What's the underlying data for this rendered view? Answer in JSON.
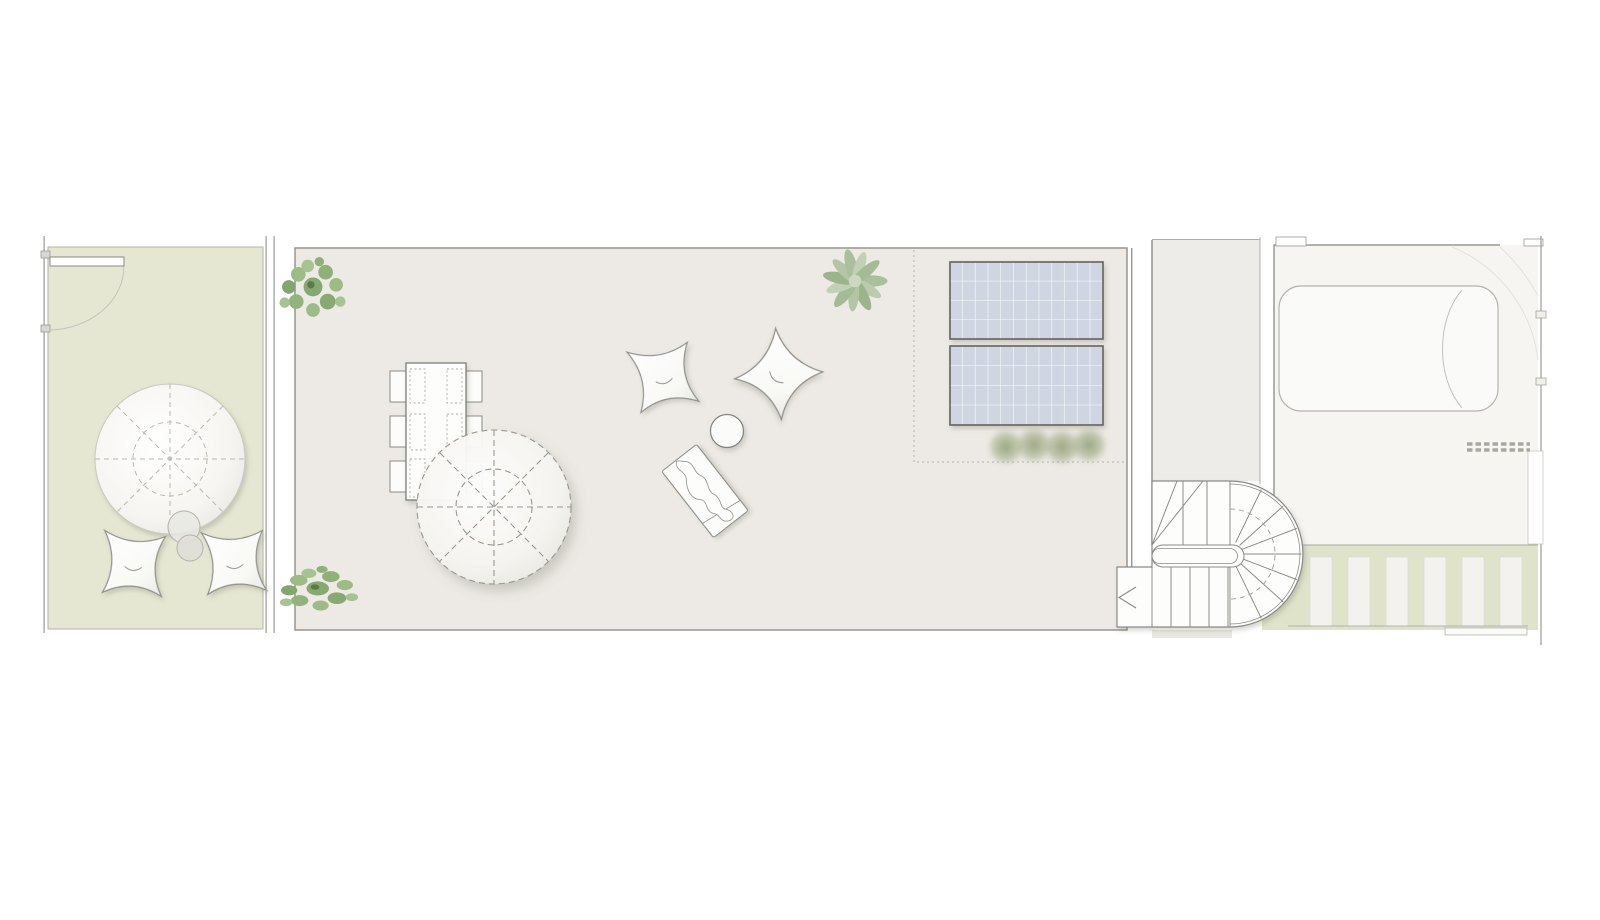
{
  "document": {
    "kind": "architectural-floor-plan",
    "view": "roof-terrace-plan",
    "visible_text": [],
    "orientation": "landscape"
  },
  "palette": {
    "page_bg": "#ffffff",
    "garden_fill": "#e5e7d3",
    "garden_border": "#b3b3aa",
    "terrace_fill": "#edeae5",
    "terrace_border": "#96968e",
    "corridor_fill": "#edece8",
    "building_fill": "#f6f5f1",
    "green_strip": "#dfe3ca",
    "paver": "#f3f2ee",
    "wall": "#9a9a94",
    "wall_light": "#b0b0a8",
    "line_dark": "#8a8a85",
    "furniture_fill": "#fcfcfa",
    "furniture_stroke": "#90908a",
    "dash_line": "#b2b2aa",
    "solar_fill": "#cfd6e2",
    "solar_border": "#63635f",
    "solar_grid": "#ffffff",
    "foliage_dark": "#76975f",
    "foliage_mid": "#8aab72",
    "foliage_light": "#a3c089",
    "sage_dark": "#93ac86",
    "sage_light": "#bccbaf",
    "olive": "#8f9f72",
    "car_stroke": "#b7b5b0",
    "faint_arc": "#e4e2dc"
  },
  "sections": [
    {
      "id": "left-garden",
      "items": [
        "boundary-wall",
        "entry-door-swing",
        "large-parasol",
        "side-table-pair",
        "butterfly-chair",
        "butterfly-chair"
      ]
    },
    {
      "id": "main-terrace",
      "items": [
        "corner-plant",
        "corner-plant",
        "dining-table-6-chairs",
        "large-parasol-dashed",
        "butterfly-chair",
        "butterfly-chair",
        "round-side-table",
        "sun-lounger-with-towel",
        "agave-plant",
        "solar-panel",
        "solar-panel",
        "shrub-row",
        "dotted-zone-boundary"
      ]
    },
    {
      "id": "stair-corridor",
      "items": [
        "corridor",
        "u-shaped-stair-with-curved-end",
        "down-arrow"
      ]
    },
    {
      "id": "neighbor-plot",
      "items": [
        "perimeter-walls",
        "parked-car",
        "ventilation-grate-dashed",
        "side-gate",
        "paver-path",
        "lawn-strip"
      ]
    }
  ],
  "counts": {
    "solar_panels": 2,
    "dining_chairs_solid": 6,
    "dining_chairs_dashed": 6,
    "butterfly_chairs": 4,
    "pavers": 6,
    "shrubs_in_row": 4
  }
}
